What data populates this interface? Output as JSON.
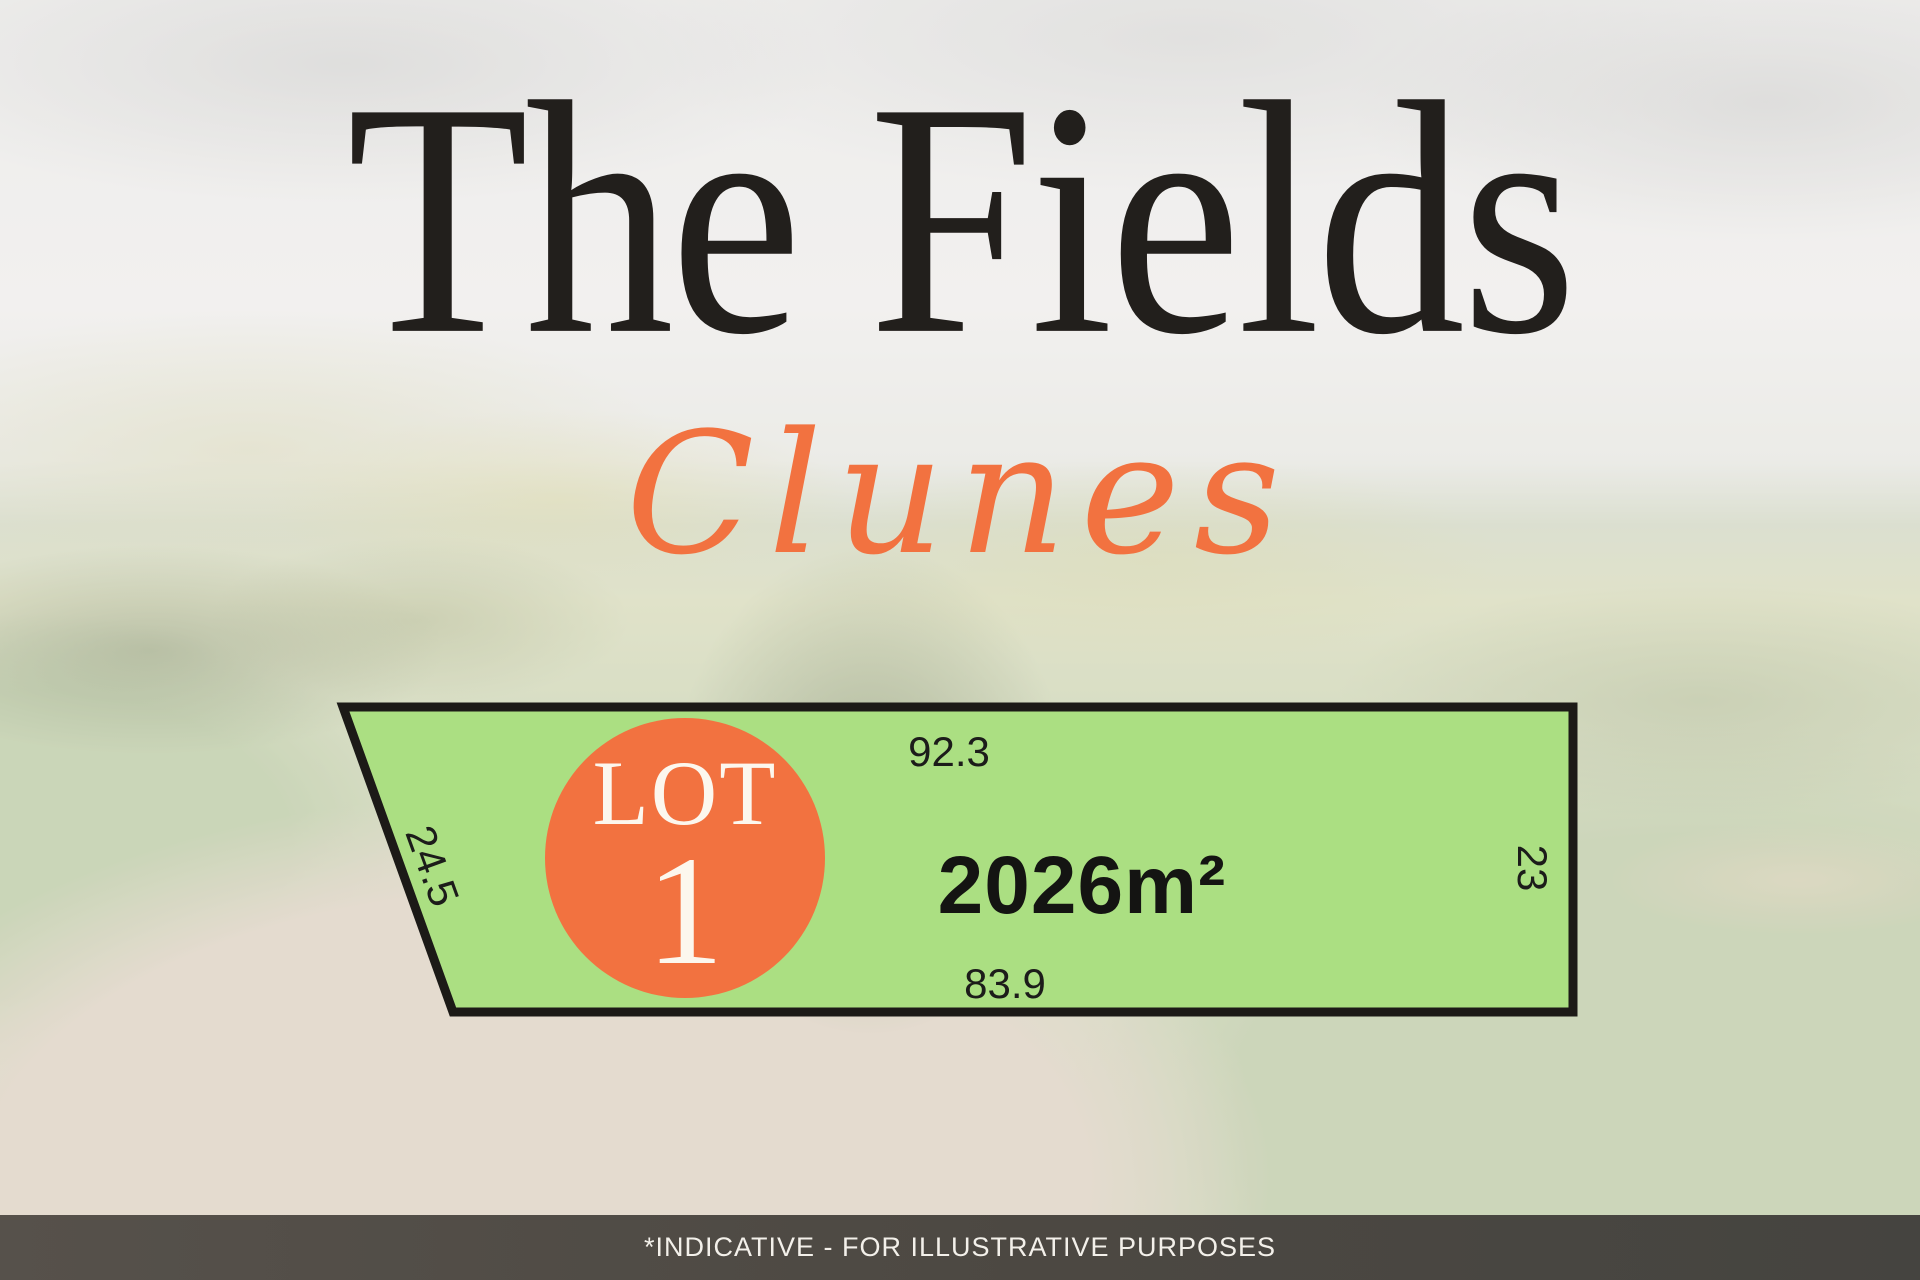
{
  "header": {
    "title": "The Fields",
    "subtitle": "Clunes"
  },
  "lot": {
    "label_word": "LOT",
    "label_number": "1",
    "area": "2026m²",
    "dimensions": {
      "top": "92.3",
      "left": "24.5",
      "right": "23",
      "bottom": "83.9"
    }
  },
  "footer": {
    "disclaimer": "*INDICATIVE - FOR ILLUSTRATIVE PURPOSES"
  },
  "colors": {
    "accent_orange": "#f27240",
    "lot_green": "#abdf82",
    "outline_black": "#1c1a17",
    "title_black": "#221f1c",
    "footer_bg": "#4c4842"
  }
}
